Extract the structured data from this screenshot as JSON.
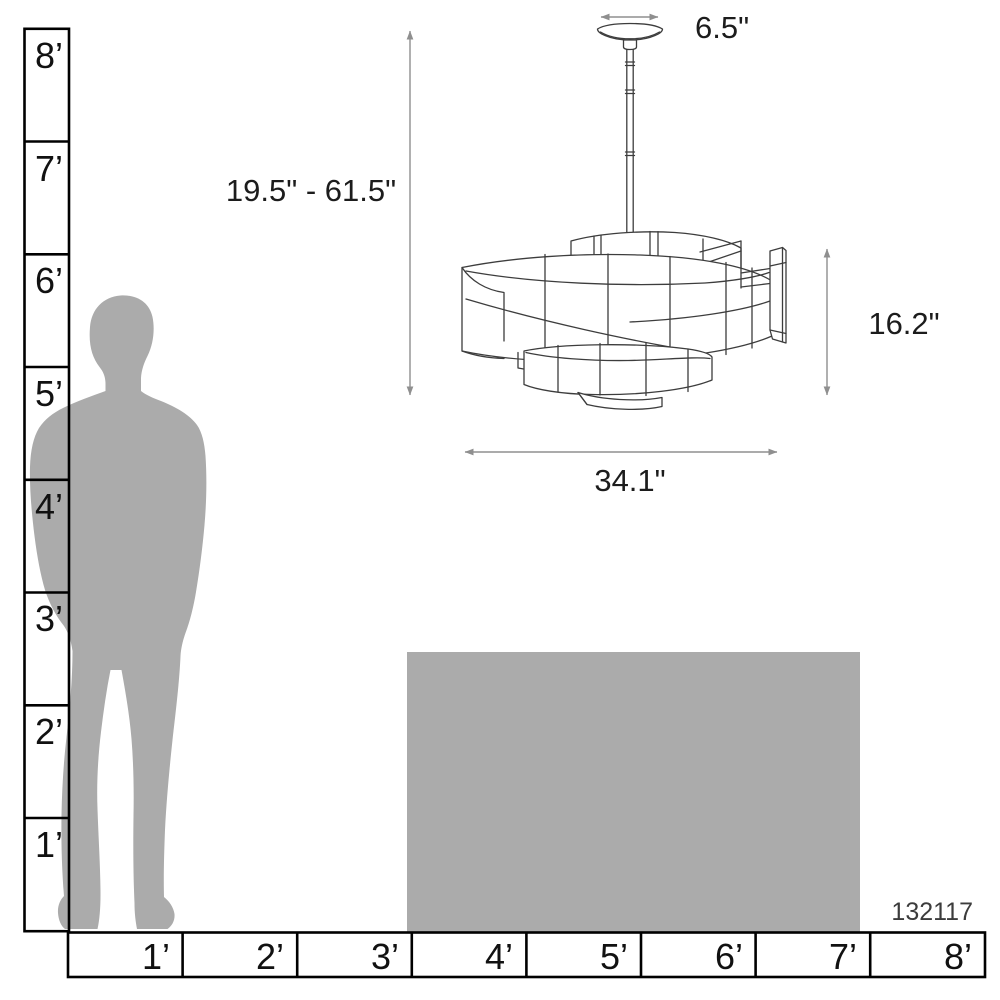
{
  "diagram": {
    "product_code": "132117",
    "dimensions": {
      "canopy_width": "6.5\"",
      "height_range": "19.5\" - 61.5\"",
      "fixture_height": "16.2\"",
      "fixture_width": "34.1\""
    },
    "vertical_ruler_labels": [
      "8’",
      "7’",
      "6’",
      "5’",
      "4’",
      "3’",
      "2’",
      "1’"
    ],
    "horizontal_ruler_labels": [
      "1’",
      "2’",
      "3’",
      "4’",
      "5’",
      "6’",
      "7’",
      "8’"
    ],
    "colors": {
      "silhouette": "#ababab",
      "ruler_line": "#000000",
      "drawing_line": "#3d3d3d",
      "dimension_line": "#8f8f8f",
      "label_text": "#1a1a1a"
    }
  }
}
